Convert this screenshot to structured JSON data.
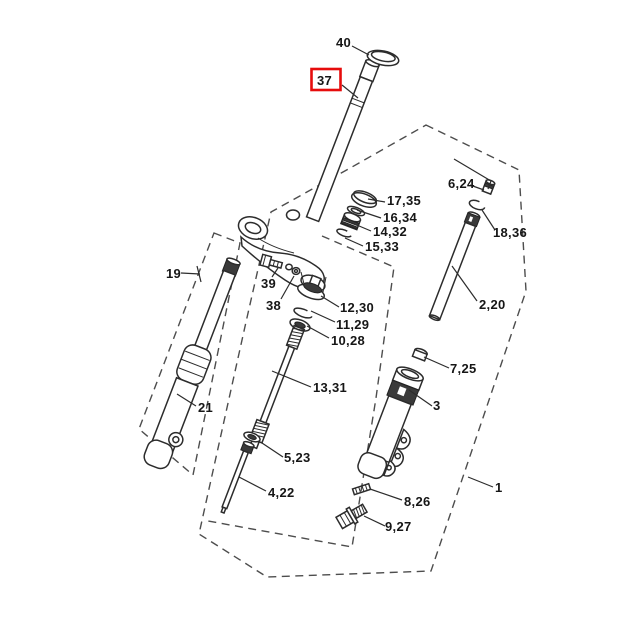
{
  "diagram": {
    "kind": "exploded-parts-diagram",
    "highlight": {
      "label": "37",
      "box_color": "#e60c0c"
    },
    "colors": {
      "line": "#2c2c2c",
      "dash_line": "#4d4d4d",
      "label_text": "#161616",
      "background": "#ffffff"
    }
  },
  "labels": [
    {
      "id": "40",
      "text": "40"
    },
    {
      "id": "37",
      "text": "37"
    },
    {
      "id": "17-35",
      "text": "17,35"
    },
    {
      "id": "16-34",
      "text": "16,34"
    },
    {
      "id": "14-32",
      "text": "14,32"
    },
    {
      "id": "15-33",
      "text": "15,33"
    },
    {
      "id": "6-24",
      "text": "6,24"
    },
    {
      "id": "18-36",
      "text": "18,36"
    },
    {
      "id": "2-20",
      "text": "2,20"
    },
    {
      "id": "12-30",
      "text": "12,30"
    },
    {
      "id": "11-29",
      "text": "11,29"
    },
    {
      "id": "10-28",
      "text": "10,28"
    },
    {
      "id": "19",
      "text": "19"
    },
    {
      "id": "39",
      "text": "39"
    },
    {
      "id": "38",
      "text": "38"
    },
    {
      "id": "21",
      "text": "21"
    },
    {
      "id": "13-31",
      "text": "13,31"
    },
    {
      "id": "7-25",
      "text": "7,25"
    },
    {
      "id": "3",
      "text": "3"
    },
    {
      "id": "5-23",
      "text": "5,23"
    },
    {
      "id": "4-22",
      "text": "4,22"
    },
    {
      "id": "8-26",
      "text": "8,26"
    },
    {
      "id": "9-27",
      "text": "9,27"
    },
    {
      "id": "1",
      "text": "1"
    }
  ]
}
